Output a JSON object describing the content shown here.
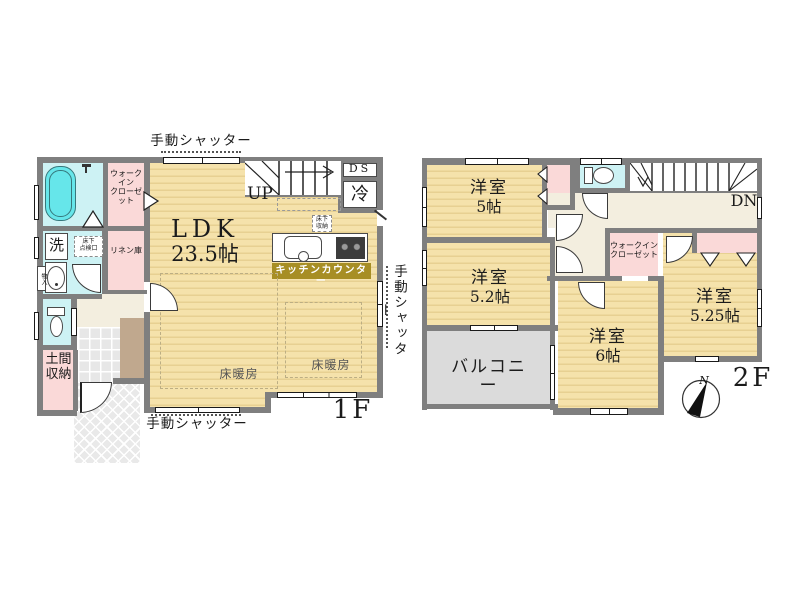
{
  "floor1": {
    "label": "1F",
    "shutter_top": "手動シャッター",
    "shutter_right": "手動シャッター",
    "shutter_bottom": "手動シャッター",
    "ldk": {
      "name": "LDK",
      "size": "23.5帖"
    },
    "stairs": "UP",
    "duct_space": "DS",
    "refrigerator": "冷",
    "underfloor_storage": "床下\n収納",
    "kitchen_counter": "キッチンカウンター",
    "floor_heating_1": "床暖房",
    "floor_heating_2": "床暖房",
    "walk_in_closet": "ウォークイン\nクローゼット",
    "linen_storage": "リネン庫",
    "laundry": "洗",
    "underfloor_hatch": "床下\n点検口",
    "storage_small": "物入",
    "doma_storage": "土間\n収納"
  },
  "floor2": {
    "label": "2F",
    "compass_north": "N",
    "stairs": "DN",
    "room_a": {
      "name": "洋室",
      "size": "5帖"
    },
    "room_b": {
      "name": "洋室",
      "size": "5.2帖"
    },
    "room_c": {
      "name": "洋室",
      "size": "6帖"
    },
    "room_d": {
      "name": "洋室",
      "size": "5.25帖"
    },
    "walk_in_closet": "ウォークイン\nクローゼット",
    "balcony": "バルコニー"
  }
}
